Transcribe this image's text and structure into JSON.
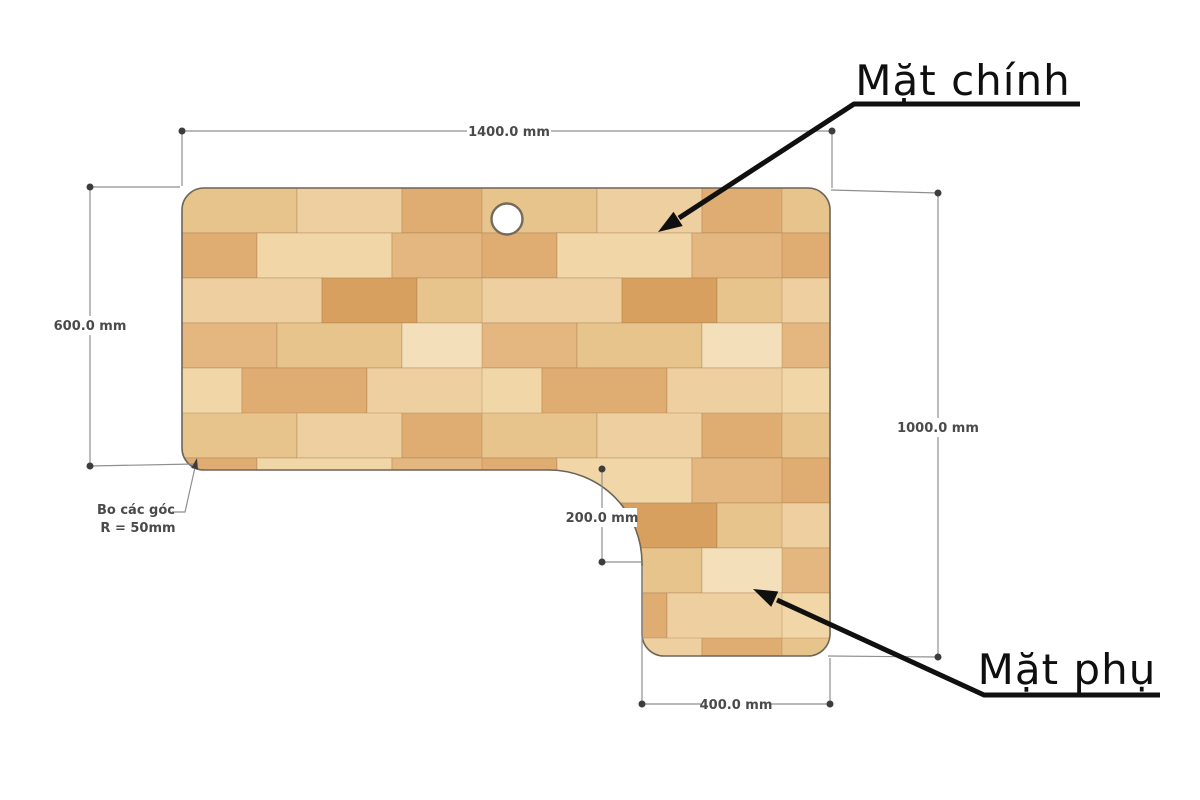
{
  "diagram": {
    "labels": {
      "main_surface": "Mặt chính",
      "secondary_surface": "Mặt phụ"
    },
    "dimensions": {
      "top_width": "1400.0 mm",
      "left_height": "600.0 mm",
      "right_height": "1000.0 mm",
      "inner_corner_offset": "200.0 mm",
      "bottom_width": "400.0 mm"
    },
    "corner_note": {
      "line1": "Bo các góc",
      "line2": "R = 50mm"
    },
    "colors": {
      "wood_light": "#f1d7a7",
      "wood_pale": "#f3dfba",
      "wood_tan": "#e8c48d",
      "wood_medium": "#e3b77f",
      "wood_orange": "#dfad72",
      "wood_dark": "#d7a05f",
      "outline": "#6e6459",
      "dimension_line": "#8f8f8f",
      "dimension_text": "#4a4a4a",
      "callout": "#101010"
    }
  }
}
